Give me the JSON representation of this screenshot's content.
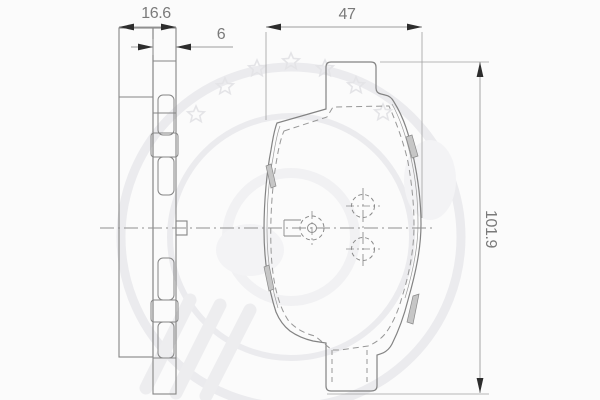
{
  "drawing": {
    "type": "brake-pad-two-view-technical-drawing",
    "views": {
      "side_view": "side-profile-with-spring-clips",
      "front_view": "backplate-face-with-mounting-holes"
    },
    "dimensions": {
      "total_thickness": {
        "label": "16.6"
      },
      "backplate_thickness": {
        "label": "6"
      },
      "width": {
        "label": "47"
      },
      "height": {
        "label": "101.9"
      }
    },
    "watermark": {
      "icon": "optimal-logo-watermark",
      "color": "#ebebee"
    },
    "colors": {
      "background": "#fbfbfb",
      "outline": "#838383",
      "hidden_dash": "#979797",
      "centerline": "#8f8f8f",
      "dimension_line": "#9c9c9c",
      "arrow": "#2d2d2d",
      "label_text": "#7a7a7a",
      "sliver_fill": "#c6c6c6"
    }
  }
}
